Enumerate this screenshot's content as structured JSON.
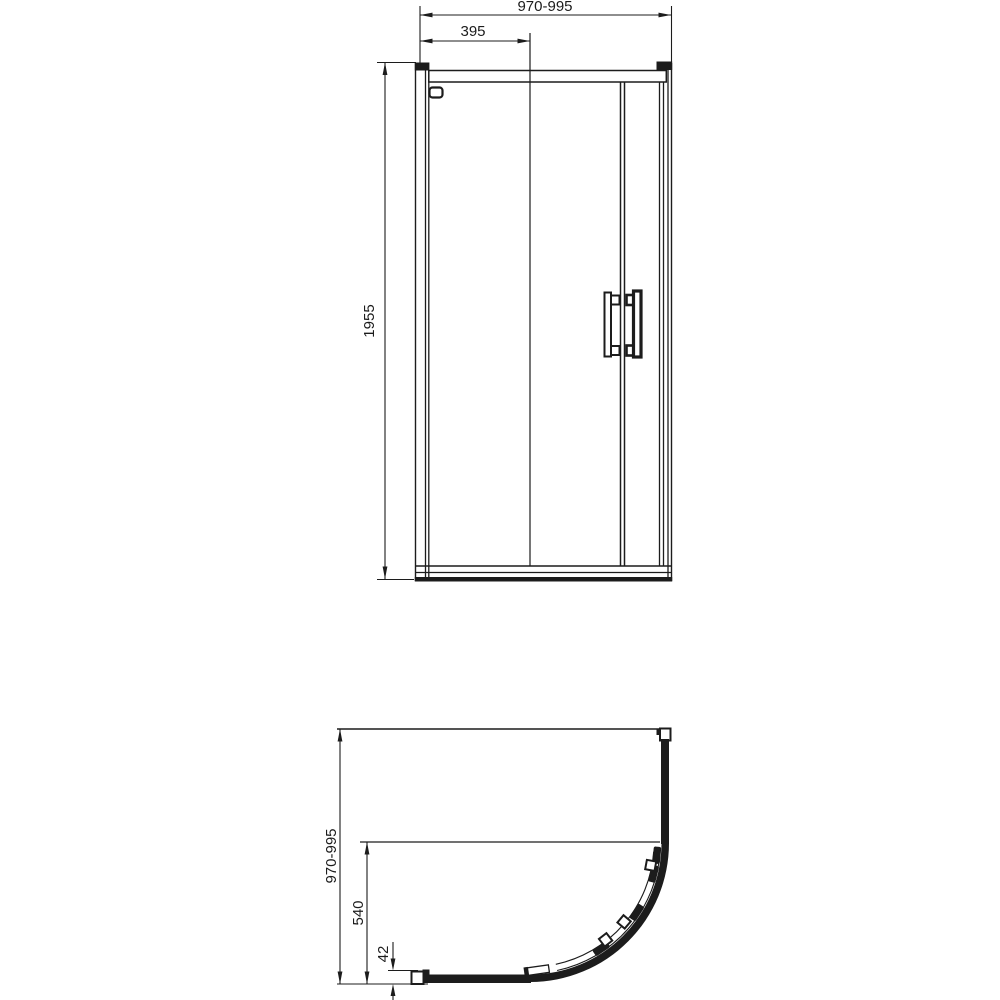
{
  "page": {
    "background_color": "#ffffff",
    "line_color": "#1c1c1c",
    "description": "Technical dimension drawing of a quadrant sliding-door shower enclosure, front elevation above and plan view below"
  },
  "front_view": {
    "view_name": "front-elevation",
    "dimensions": {
      "overall_width": "970-995",
      "fixed_panel_width": "395",
      "height": "1955"
    }
  },
  "plan_view": {
    "view_name": "plan-view",
    "dimensions": {
      "overall_depth": "970-995",
      "door_opening": "540",
      "profile_adjustment": "42"
    }
  }
}
